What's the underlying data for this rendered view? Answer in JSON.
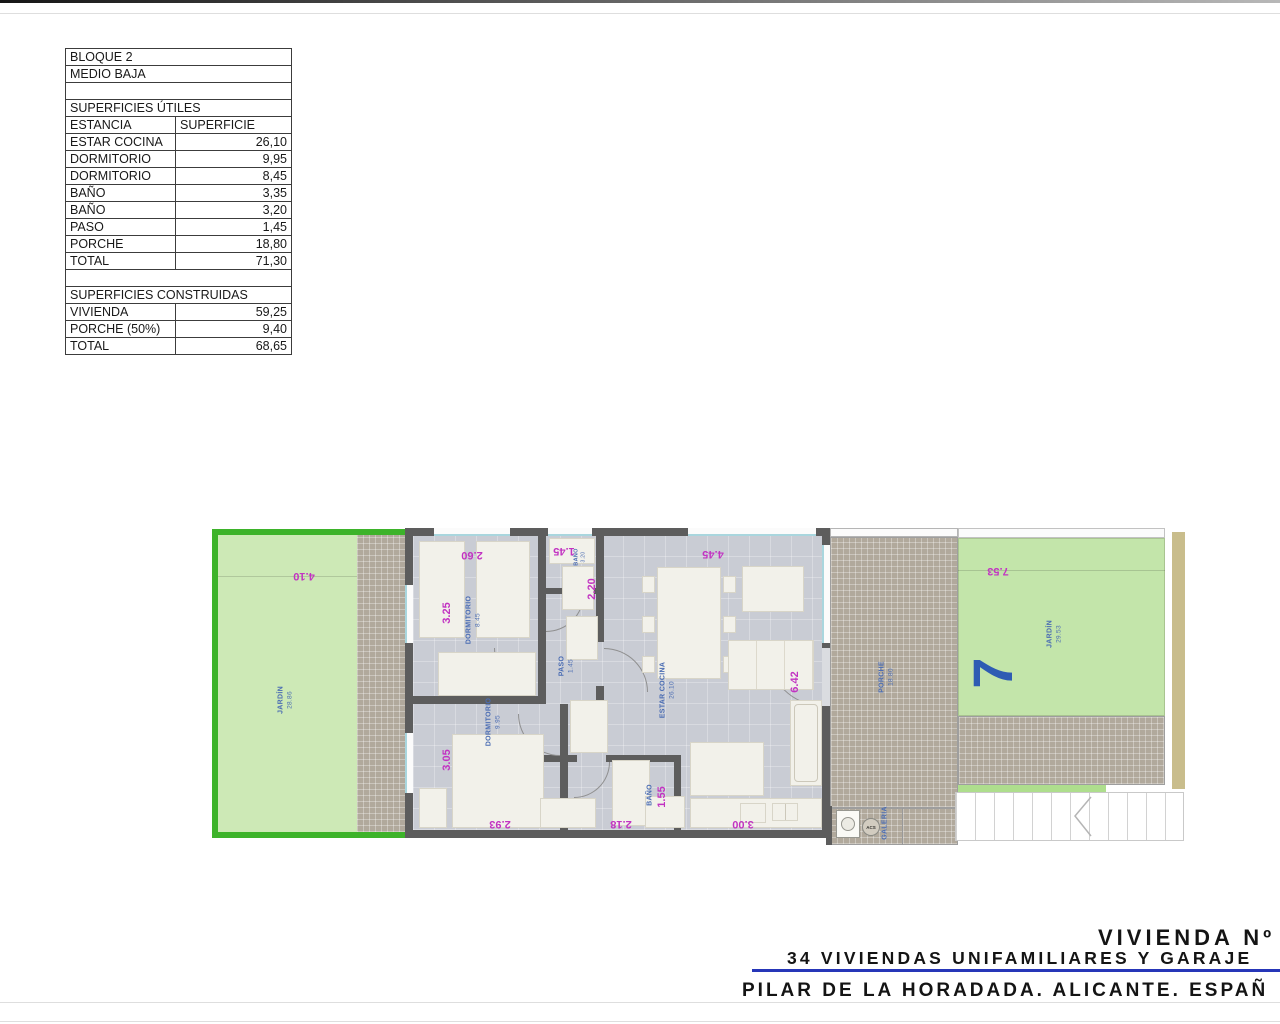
{
  "area_table": {
    "row_bloque": "BLOQUE 2",
    "row_planta": "MEDIO BAJA",
    "utiles_title": "SUPERFICIES ÚTILES",
    "col_estancia": "ESTANCIA",
    "col_superficie": "SUPERFICIE",
    "utiles_rows": [
      [
        "ESTAR COCINA",
        "26,10"
      ],
      [
        "DORMITORIO",
        "9,95"
      ],
      [
        "DORMITORIO",
        "8,45"
      ],
      [
        "BAÑO",
        "3,35"
      ],
      [
        "BAÑO",
        "3,20"
      ],
      [
        "PASO",
        "1,45"
      ],
      [
        "PORCHE",
        "18,80"
      ],
      [
        "TOTAL",
        "71,30"
      ]
    ],
    "construidas_title": "SUPERFICIES CONSTRUIDAS",
    "construidas_rows": [
      [
        "VIVIENDA",
        "59,25"
      ],
      [
        "PORCHE (50%)",
        "9,40"
      ],
      [
        "TOTAL",
        "68,65"
      ]
    ]
  },
  "plan": {
    "jardin_left": {
      "label": "JARDÍN",
      "area": "28.86",
      "dim": "4.10"
    },
    "dormitorio_top": {
      "label": "DORMITORIO",
      "area": "8.45",
      "dim_v": "3.25",
      "dim_h": "2.60"
    },
    "dormitorio_bottom": {
      "label": "DORMITORIO",
      "area": "9.95",
      "dim_v": "3.05",
      "dim_h": "2.93"
    },
    "bano_top": {
      "label": "BAÑO",
      "area": "3.20",
      "dim_h": "1.45"
    },
    "bano_bottom": {
      "label": "BAÑO",
      "dim_v": "1.55",
      "dim_h": "2.18"
    },
    "paso": {
      "label": "PASO",
      "area": "1.45",
      "dim_v": "2.20"
    },
    "estar_cocina": {
      "label": "ESTAR COCINA",
      "area": "26.10",
      "dim_top": "4.45",
      "dim_right": "6.42",
      "dim_bottom": "3.00"
    },
    "porche": {
      "label": "PORCHE",
      "area": "18.80"
    },
    "galeria": {
      "label": "GALERIA",
      "acs": "ACS"
    },
    "jardin_right": {
      "label": "JARDÍN",
      "area": "29.53",
      "dim": "7.53",
      "unit_number": "7"
    }
  },
  "title_block": {
    "line1": "VIVIENDA Nº",
    "line2": "34 VIVIENDAS UNIFAMILIARES Y GARAJE",
    "line3": "PILAR DE LA HORADADA. ALICANTE. ESPAÑ"
  },
  "colors": {
    "garden_border": "#3db32a",
    "garden_fill": "#cde9b6",
    "garden_fill_right": "#c3e5aa",
    "hatch": "#b1a99c",
    "floor": "#c9ccd4",
    "wall": "#5d5d5d",
    "furniture": "#f2f1ea",
    "label_blue": "#4a6cb3",
    "dim_magenta": "#c233c2",
    "number_blue": "#2e5cb3",
    "title_blue": "#2636b8",
    "khaki": "#c9bd8c"
  }
}
